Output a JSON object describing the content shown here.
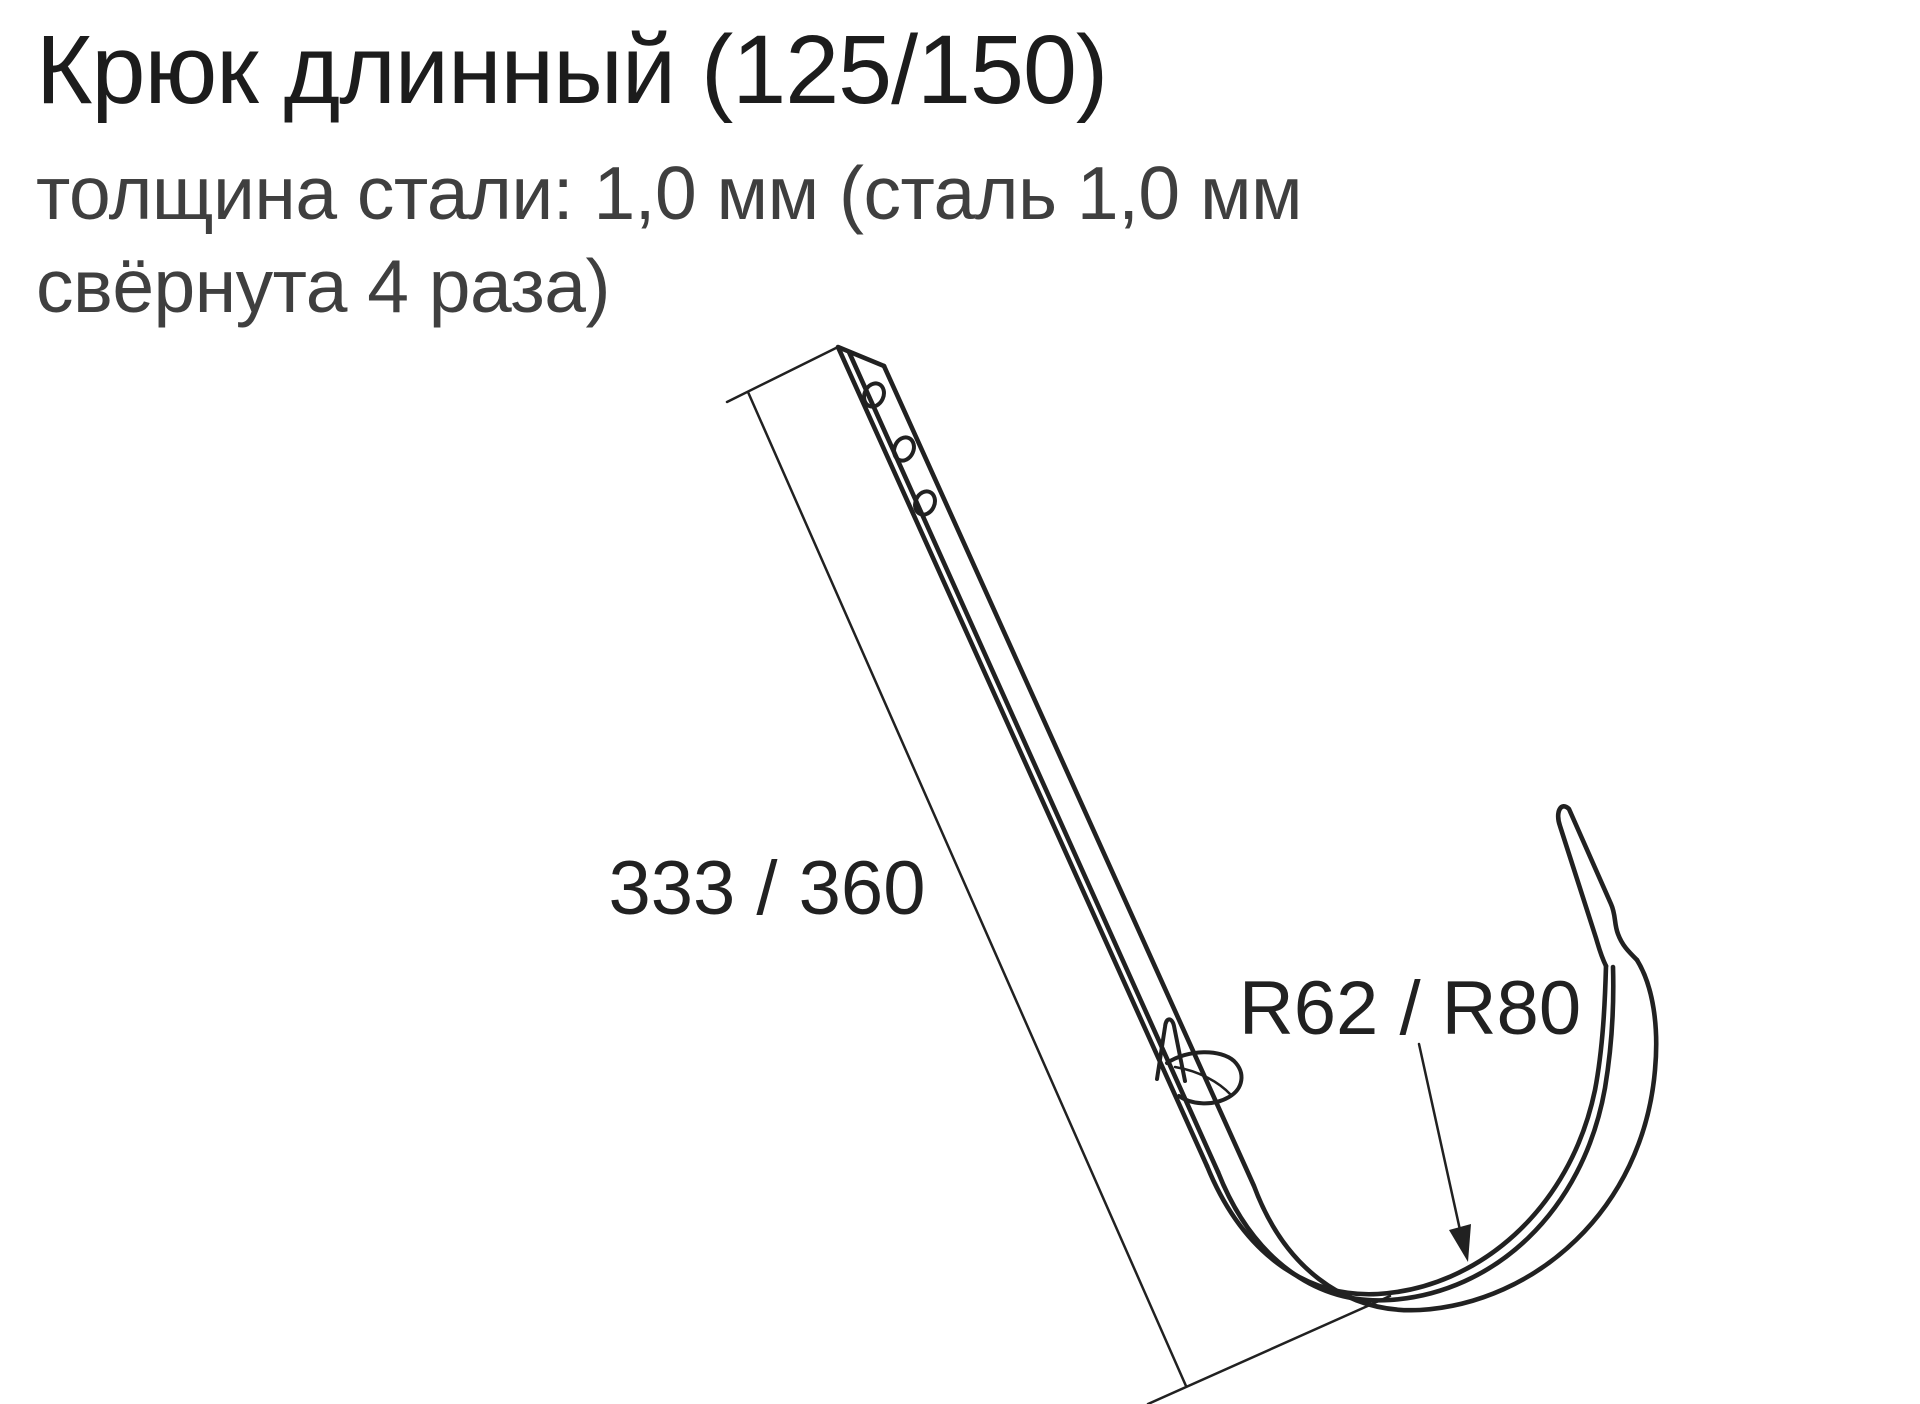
{
  "page": {
    "background": "#ffffff"
  },
  "header": {
    "title": "Крюк длинный (125/150)",
    "title_color": "#1c1c1c",
    "subtitle_line1": "толщина стали: 1,0 мм (сталь 1,0 мм",
    "subtitle_line2": "свёрнута 4 раза)",
    "subtitle_color": "#3f3f3f"
  },
  "diagram": {
    "line_color": "#212121",
    "labels": {
      "length": "333 / 360",
      "radius": "R62 / R80"
    },
    "screw_hole_count": "3"
  }
}
